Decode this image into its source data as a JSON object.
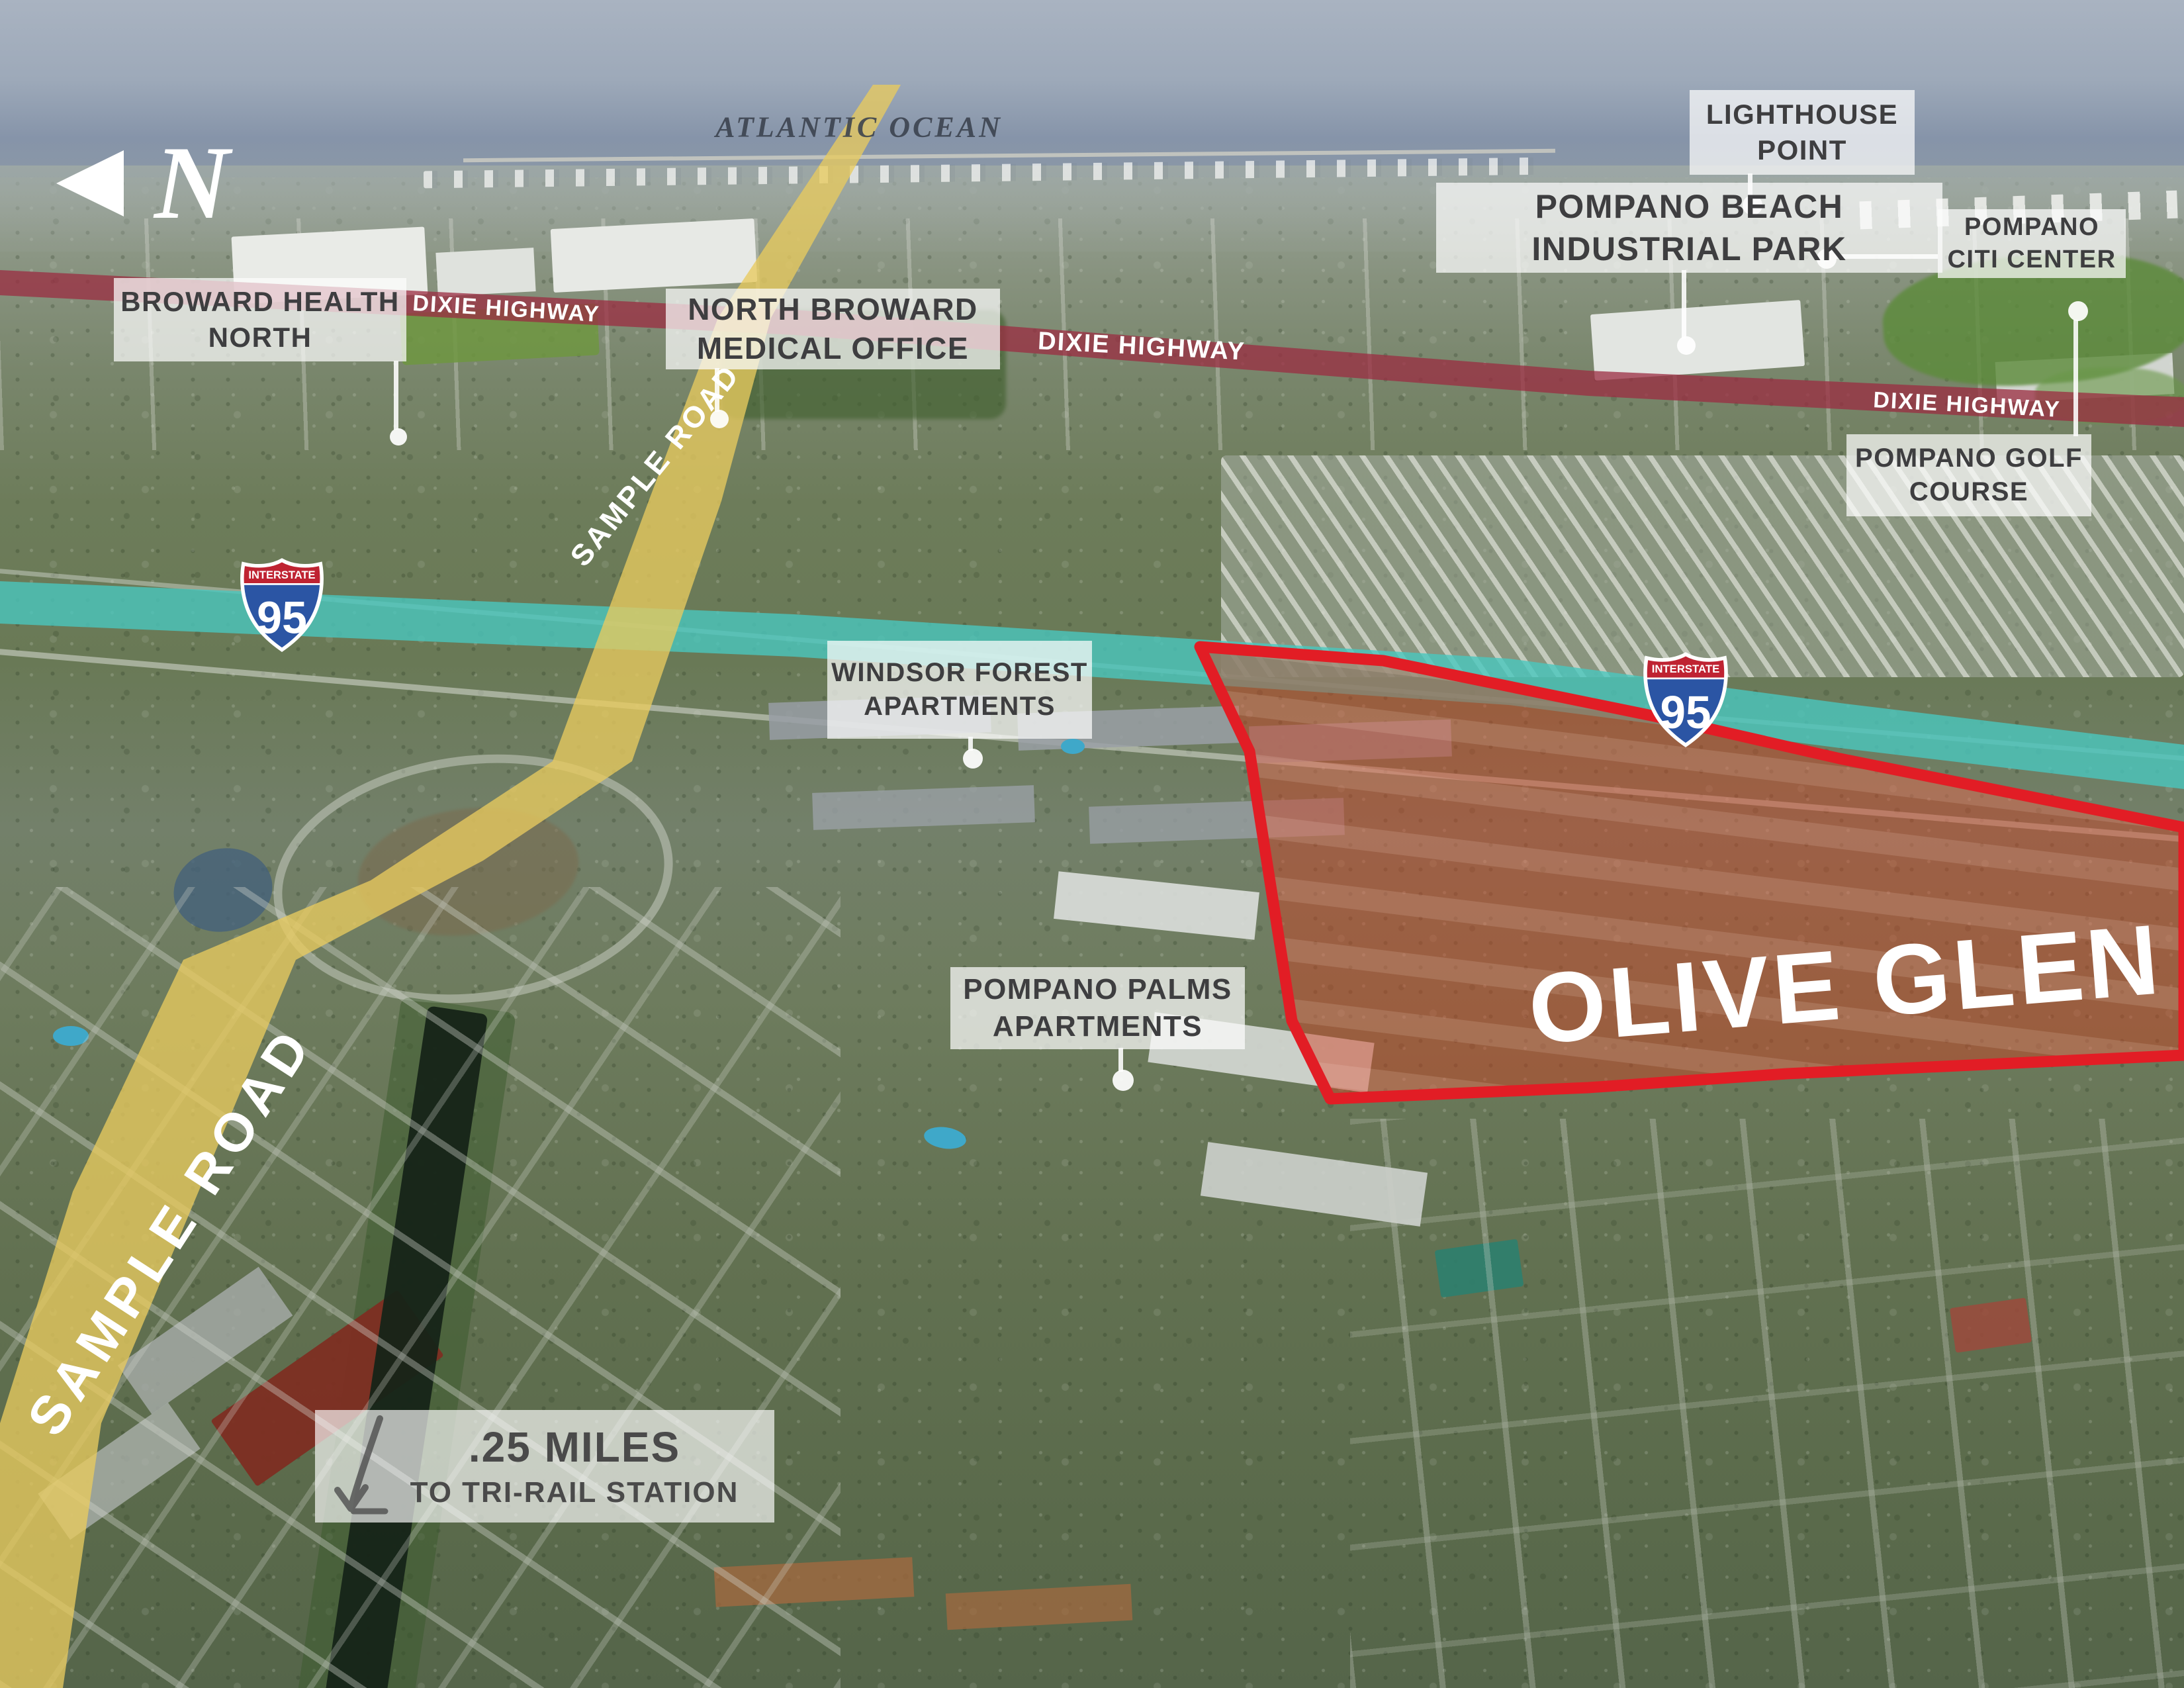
{
  "map": {
    "north_indicator": {
      "label": "N"
    },
    "ocean_label": "ATLANTIC OCEAN",
    "property": {
      "name": "OLIVE GLEN",
      "highlight_color": "#e02128"
    },
    "callouts": [
      {
        "line1": "BROWARD HEALTH",
        "line2": "NORTH"
      },
      {
        "line1": "NORTH BROWARD",
        "line2": "MEDICAL OFFICE"
      },
      {
        "line1": "LIGHTHOUSE",
        "line2": "POINT"
      },
      {
        "line1": "POMPANO BEACH",
        "line2": "INDUSTRIAL PARK"
      },
      {
        "line1": "POMPANO",
        "line2": "CITI CENTER"
      },
      {
        "line1": "POMPANO GOLF",
        "line2": "COURSE"
      },
      {
        "line1": "WINDSOR FOREST",
        "line2": "APARTMENTS"
      },
      {
        "line1": "POMPANO PALMS",
        "line2": "APARTMENTS"
      }
    ],
    "roads": {
      "dixie_highway": {
        "label": "DIXIE HIGHWAY",
        "highlight_color": "#a23247"
      },
      "sample_road": {
        "label": "SAMPLE ROAD",
        "highlight_color": "#e8ca5f"
      },
      "interstate_95": {
        "shield_header": "INTERSTATE",
        "shield_number": "95",
        "highlight_color": "#4ec7bd"
      }
    },
    "distance_callout": {
      "line1": ".25 MILES",
      "line2": "TO TRI-RAIL STATION"
    }
  }
}
